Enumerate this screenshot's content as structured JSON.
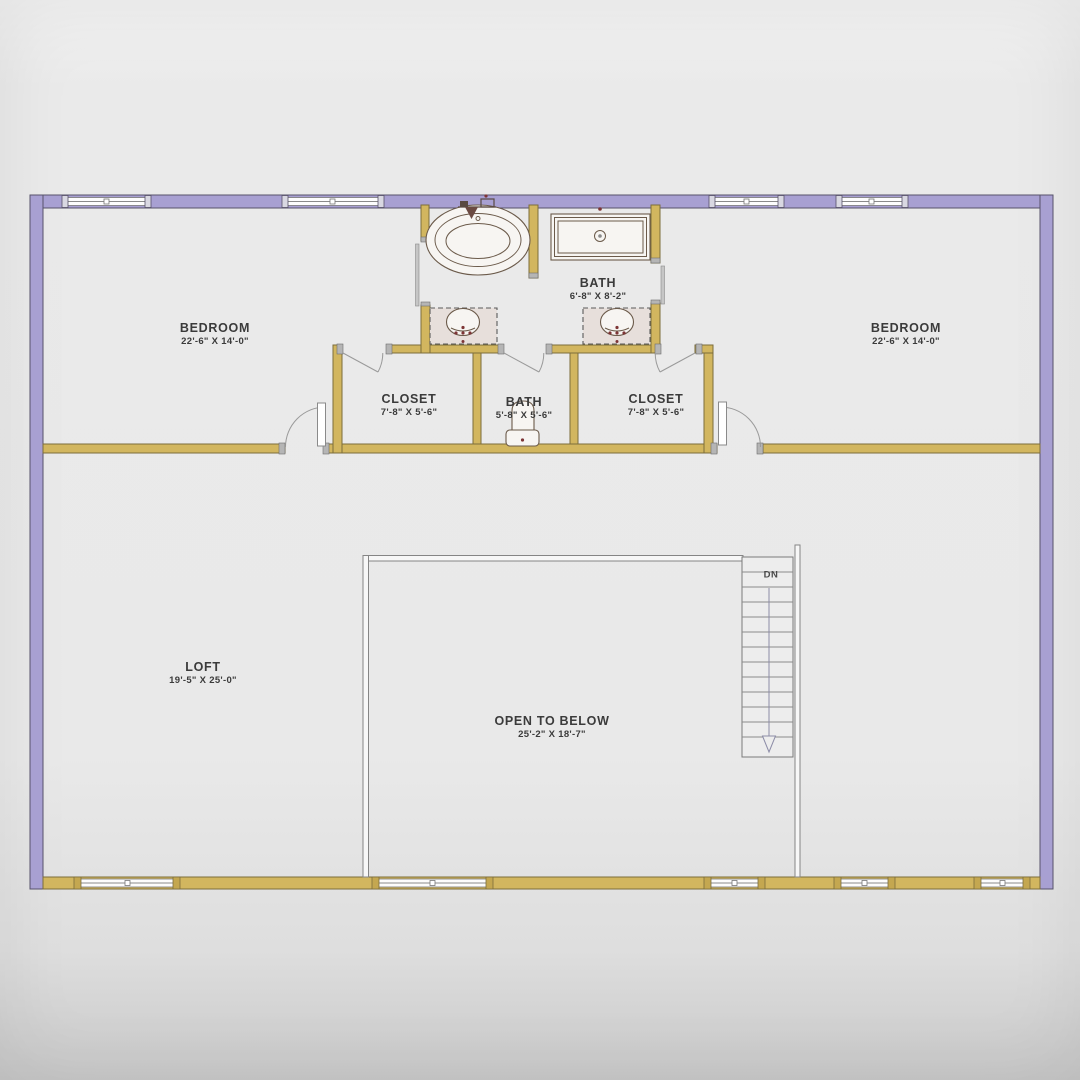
{
  "plan": {
    "type": "floor-plan",
    "level_features": [
      "two bedrooms",
      "two closets",
      "two baths",
      "loft",
      "open to below",
      "stairs down"
    ]
  },
  "rooms": [
    {
      "id": "bedroom-left",
      "name": "BEDROOM",
      "dims": "22'-6\" X 14'-0\""
    },
    {
      "id": "bedroom-right",
      "name": "BEDROOM",
      "dims": "22'-6\" X 14'-0\""
    },
    {
      "id": "bath-main",
      "name": "BATH",
      "dims": "6'-8\" X 8'-2\""
    },
    {
      "id": "closet-left",
      "name": "CLOSET",
      "dims": "7'-8\" X 5'-6\""
    },
    {
      "id": "bath-center",
      "name": "BATH",
      "dims": "5'-8\" X 5'-6\""
    },
    {
      "id": "closet-right",
      "name": "CLOSET",
      "dims": "7'-8\" X 5'-6\""
    },
    {
      "id": "loft",
      "name": "LOFT",
      "dims": "19'-5\" X 25'-0\""
    },
    {
      "id": "open-to-below",
      "name": "OPEN TO BELOW",
      "dims": "25'-2\" X 18'-7\""
    }
  ],
  "stairs": {
    "label": "DN"
  },
  "colors": {
    "background": "#e9e9e9",
    "wall_exterior": "#a8a0d2",
    "wall_exterior_edge": "#57526b",
    "wall_interior": "#d2b65f",
    "wall_interior_edge": "#7c6d3b",
    "window_post_top": "#d9d8e2",
    "window_post_bottom": "#c4a750",
    "counter_fill": "#e7dfdb",
    "fixture_line": "#6b5a4a",
    "thin_line": "#8a8a8a",
    "arrow_line": "#8d8da8",
    "accent_dot": "#7d3536",
    "text": "#3b3b3b"
  }
}
